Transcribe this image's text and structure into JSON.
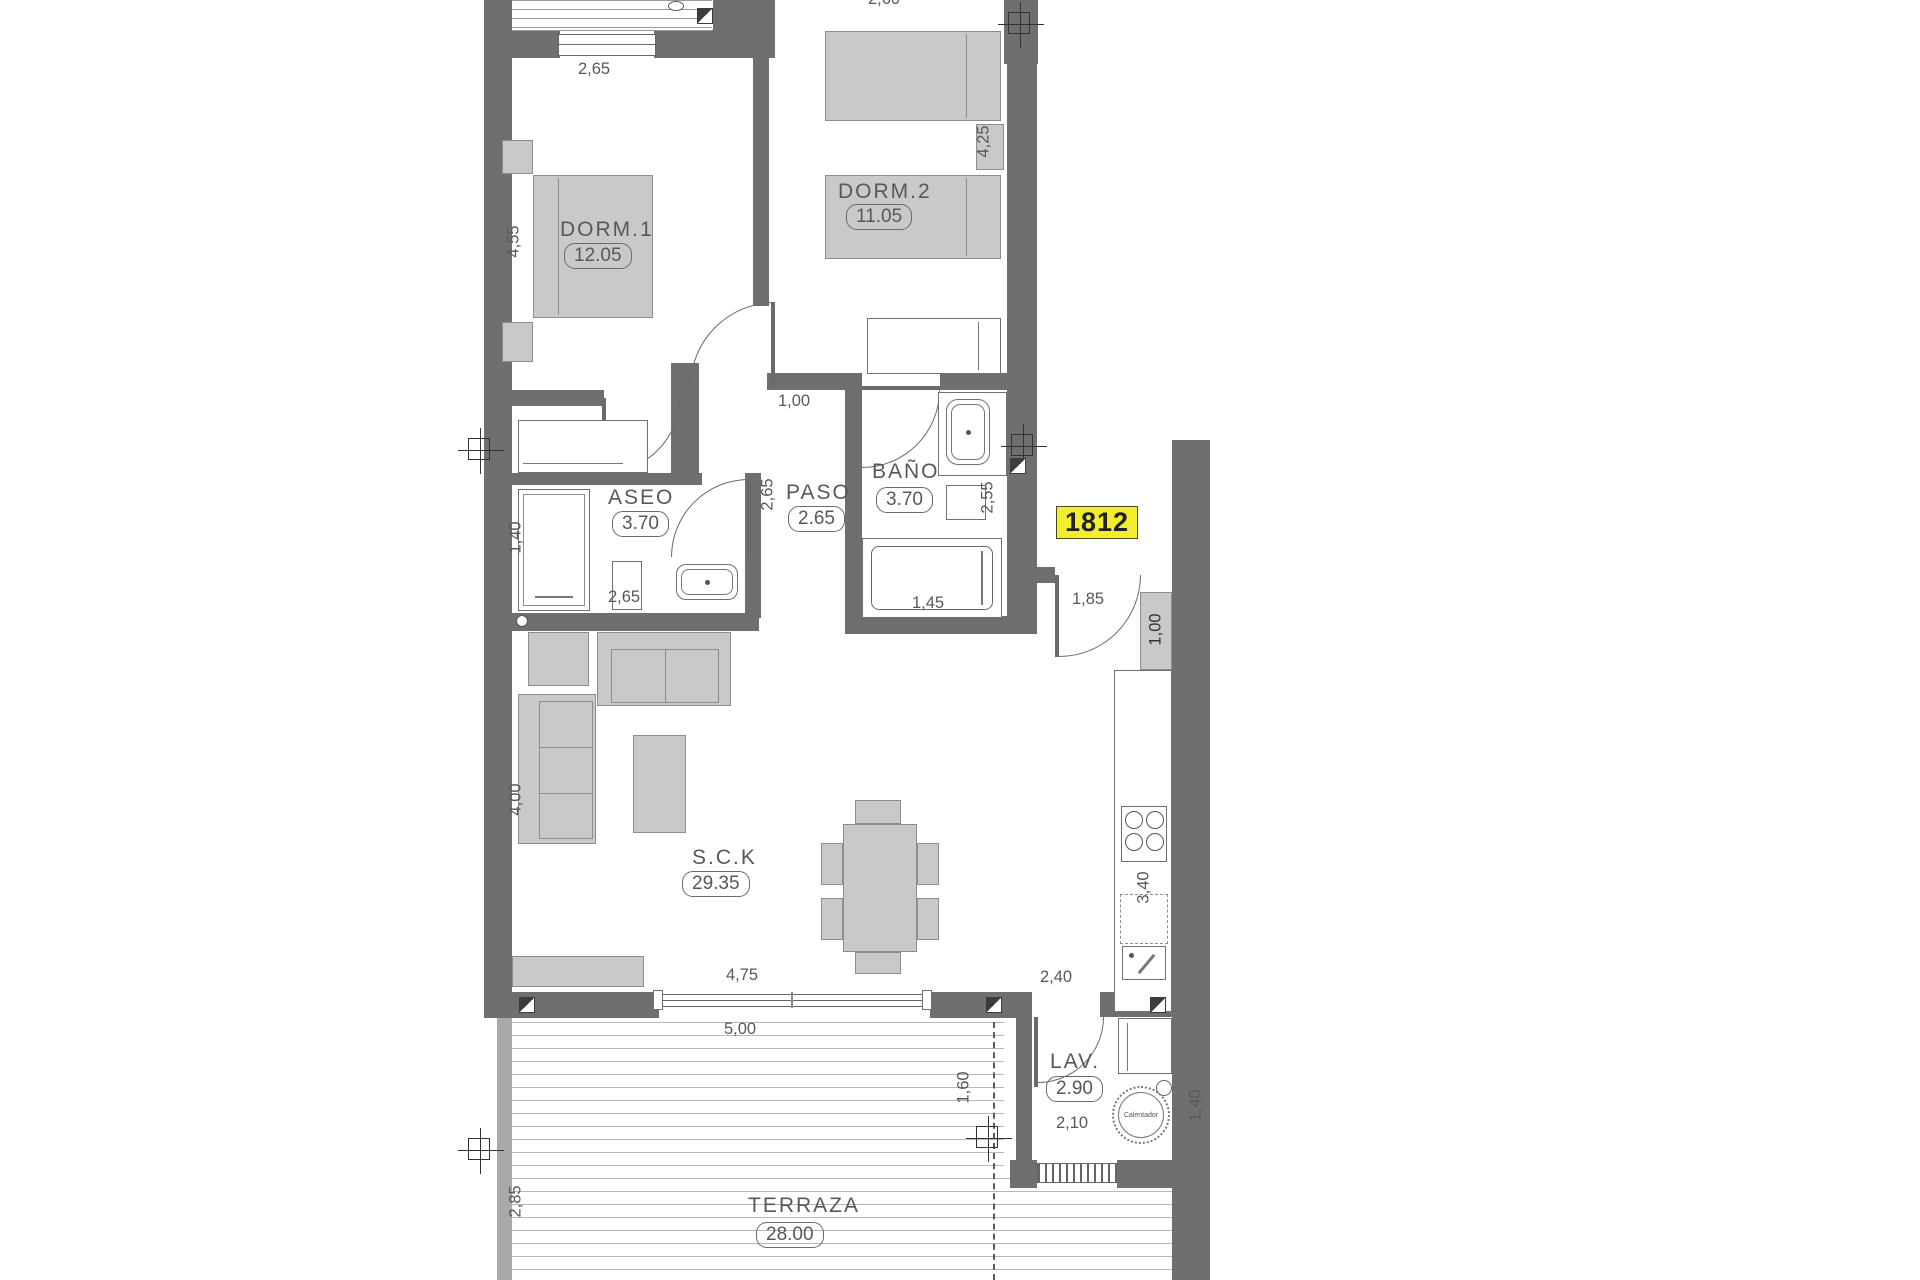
{
  "unit": {
    "number": "1812"
  },
  "rooms": {
    "dorm1": {
      "name": "DORM.1",
      "area": "12.05"
    },
    "dorm2": {
      "name": "DORM.2",
      "area": "11.05"
    },
    "aseo": {
      "name": "ASEO",
      "area": "3.70"
    },
    "paso": {
      "name": "PASO",
      "area": "2.65"
    },
    "bano": {
      "name": "BAÑO",
      "area": "3.70"
    },
    "salon": {
      "name": "S.C.K",
      "area": "29.35"
    },
    "lavadero": {
      "name": "LAV.",
      "area": "2.90"
    },
    "terraza": {
      "name": "TERRAZA",
      "area": "28.00"
    }
  },
  "dims": {
    "dorm1_window": "2,65",
    "dorm1_depth": "4,55",
    "dorm2_top_partial": "2,60",
    "dorm2_depth": "4,25",
    "hall_door": "1,00",
    "aseo_depth": "1,40",
    "aseo_width": "2,65",
    "paso_depth": "2,65",
    "bano_depth": "2,55",
    "bathtub_width": "1,45",
    "entry_door": "1,85",
    "entry_closet": "1,00",
    "kitchen_length": "3,40",
    "kitchen_width": "2,40",
    "living_depth": "4,00",
    "slider_width": "4,75",
    "terrace_width": "5,00",
    "terrace_depth": "2,85",
    "lav_offset": "1,60",
    "lav_width": "2,10",
    "lav_depth": "1,40"
  },
  "appliances": {
    "water_heater": "Calentador"
  },
  "colors": {
    "wall": "#6f6f6f",
    "furniture": "#c9c9c9",
    "unit_badge_bg": "#f2ee2e",
    "line": "#585858"
  }
}
